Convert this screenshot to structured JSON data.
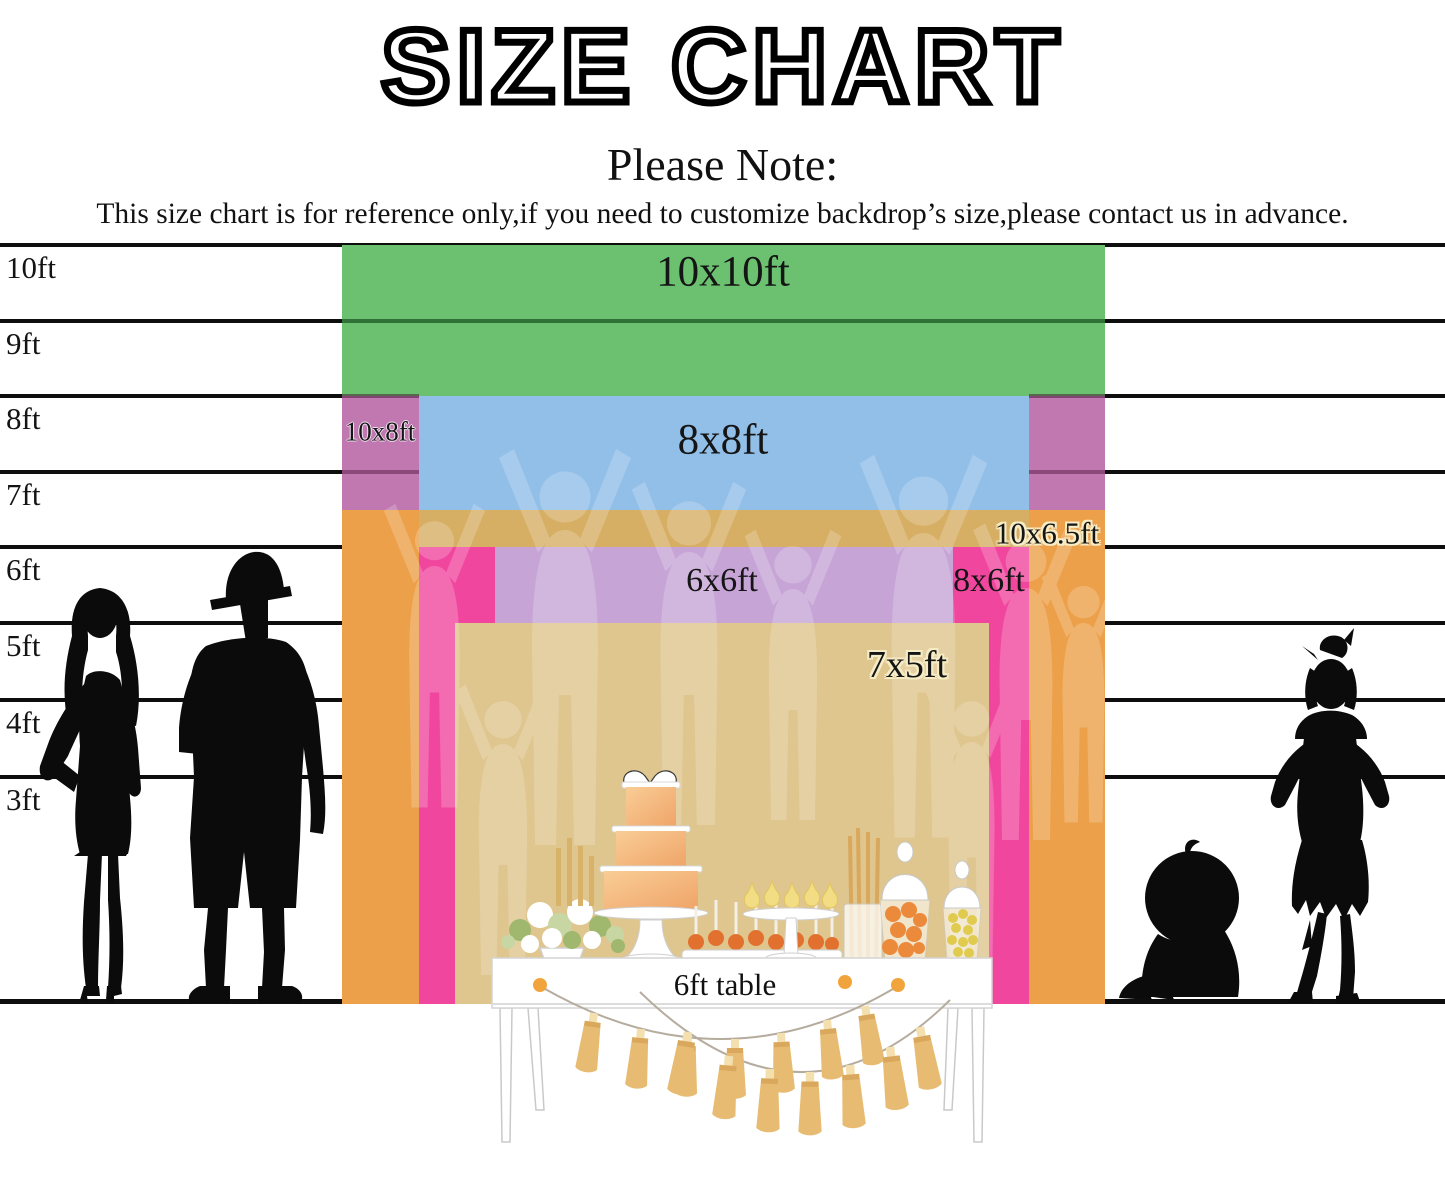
{
  "title": "SIZE CHART",
  "note": {
    "heading": "Please Note:",
    "body": "This size chart is for reference only,if you need to customize backdrop’s size,please contact us in advance."
  },
  "ruler": {
    "unit_labels": [
      "10ft",
      "9ft",
      "8ft",
      "7ft",
      "6ft",
      "5ft",
      "4ft",
      "3ft"
    ]
  },
  "backdrops": {
    "size_10x10": {
      "label": "10x10ft",
      "color": "#6BC16F"
    },
    "size_10x8": {
      "label": "10x8ft",
      "color": "#C178B1"
    },
    "size_8x8": {
      "label": "8x8ft",
      "color": "#92BFE8"
    },
    "size_10x6_5": {
      "label": "10x6.5ft",
      "color": "#EDA04A",
      "overlap_color": "#D6AE64"
    },
    "size_8x6": {
      "label": "8x6ft",
      "color": "#F1469E"
    },
    "size_6x6": {
      "label": "6x6ft",
      "color": "#C6A4D6"
    },
    "size_7x5": {
      "label": "7x5ft",
      "color": "#DFC58E"
    }
  },
  "table": {
    "label": "6ft table"
  },
  "silhouettes": [
    "adult-woman",
    "adult-man",
    "sitting-baby",
    "young-girl"
  ],
  "palette": {
    "ruler_line": "#0e0e0e",
    "tassel_gold": "#E7BC72",
    "tassel_cap": "#F4DFAE",
    "accent_dot": "#F2A43C",
    "cake_peach": "#F4B379"
  }
}
